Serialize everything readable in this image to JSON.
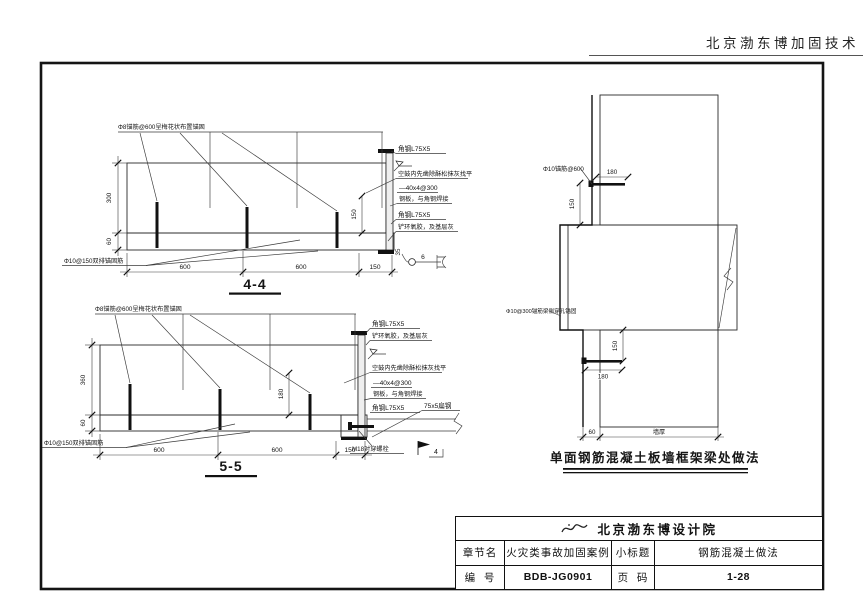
{
  "page": {
    "header": "北京渤东博加固技术"
  },
  "s44": {
    "title": "4-4",
    "note_top": "Φ8锚筋@600呈梅花状布置锚固",
    "note_anchor": "Φ10@150双排锚固筋",
    "lbl_angle1": "角钢L75X5",
    "lbl_hollow": "空鼓内先凿除酥松抹灰找平",
    "lbl_plate1": "—40x4@300",
    "lbl_plate2": "钢板，与角钢焊接",
    "lbl_angle2": "角钢L75X5",
    "lbl_epoxy": "铲环氧胶，及基层灰",
    "dim_wall": "300",
    "dim_slab": "60",
    "dim_inner": "150",
    "dim_b1": "600",
    "dim_b2": "600",
    "dim_b3": "150",
    "weld_len": "35",
    "weld_size": "6"
  },
  "s55": {
    "title": "5-5",
    "note_top": "Φ8锚筋@600呈梅花状布置锚固",
    "note_anchor": "Φ10@150双排锚固筋",
    "lbl_angle1": "角钢L75X5",
    "lbl_epoxy": "铲环氧胶，及基层灰",
    "lbl_hollow": "空鼓内先凿除酥松抹灰找平",
    "lbl_plate1": "—40x4@300",
    "lbl_plate2": "钢板，与角钢焊接",
    "lbl_angle2": "角钢L75X5",
    "lbl_flat": "75x5扁钢",
    "lbl_bolt": "M18对穿螺栓",
    "weld_num": "4",
    "dim_wall": "360",
    "dim_slab": "60",
    "dim_inner": "180",
    "dim_b1": "600",
    "dim_b2": "600",
    "dim_b3": "150"
  },
  "wall": {
    "caption": "单面钢筋混凝土板墙框架梁处做法",
    "lbl_top": "Φ10锚筋@600",
    "lbl_mid": "Φ10@300锚筋梁侧穿孔锚固",
    "dim_top180": "180",
    "dim_top150": "150",
    "dim_mid150": "150",
    "dim_mid180": "180",
    "dim_60": "60",
    "dim_wallt": "墙厚"
  },
  "tblock": {
    "company": "北京渤东博设计院",
    "r2c1": "章节名",
    "r2c2": "火灾类事故加固案例",
    "r2c3": "小标题",
    "r2c4": "钢筋混凝土做法",
    "r3c1": "编  号",
    "r3c2": "BDB-JG0901",
    "r3c3": "页  码",
    "r3c4": "1-28"
  }
}
